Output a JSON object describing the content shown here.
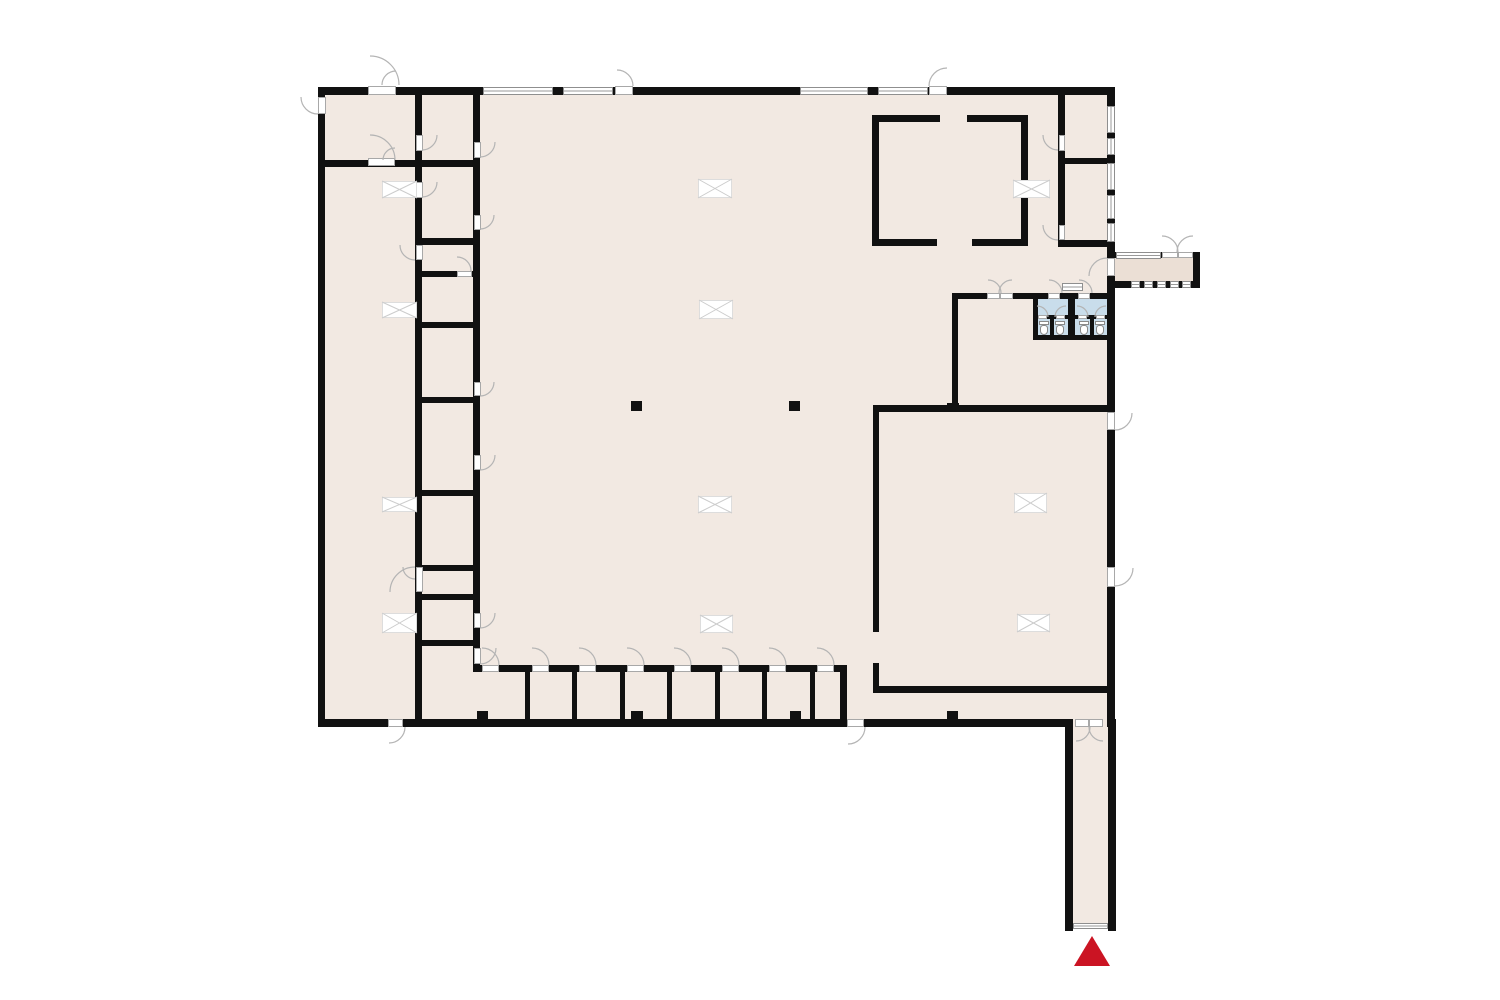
{
  "plan": {
    "canvas": {
      "width": 1500,
      "height": 1000,
      "background": "#ffffff"
    },
    "colors": {
      "floor": "#f2e9e2",
      "porch_floor": "#ebdfd5",
      "bathroom_floor": "#c9ddeb",
      "wall": "#111111",
      "door_line": "#b4b4b4",
      "window_line": "#8f8f8f",
      "hatch_line": "#cccccc",
      "marker_red": "#cb1423"
    },
    "floors": [
      {
        "rect": [
          318,
          87,
          797,
          640
        ],
        "kind": "floor"
      },
      {
        "rect": [
          1107,
          252,
          93,
          36
        ],
        "kind": "porch"
      },
      {
        "rect": [
          1065,
          719,
          51,
          206
        ],
        "kind": "floor"
      },
      {
        "rect": [
          1035,
          298,
          33,
          38
        ],
        "kind": "bath"
      },
      {
        "rect": [
          1075,
          298,
          33,
          38
        ],
        "kind": "bath"
      }
    ],
    "walls": [
      [
        318,
        87,
        797,
        8
      ],
      [
        318,
        87,
        7,
        640
      ],
      [
        318,
        719,
        754,
        8
      ],
      [
        1107,
        87,
        8,
        640
      ],
      [
        1065,
        719,
        8,
        212
      ],
      [
        1108,
        719,
        8,
        212
      ],
      [
        318,
        160,
        104,
        7
      ],
      [
        415,
        87,
        7,
        640
      ],
      [
        473,
        87,
        7,
        585
      ],
      [
        422,
        160,
        51,
        7
      ],
      [
        422,
        238,
        51,
        7
      ],
      [
        422,
        271,
        51,
        6
      ],
      [
        422,
        322,
        51,
        6
      ],
      [
        422,
        397,
        51,
        6
      ],
      [
        422,
        490,
        51,
        6
      ],
      [
        422,
        565,
        51,
        6
      ],
      [
        422,
        594,
        51,
        6
      ],
      [
        422,
        640,
        51,
        6
      ],
      [
        478,
        665,
        367,
        7
      ],
      [
        840,
        665,
        7,
        57
      ],
      [
        525,
        672,
        5,
        47
      ],
      [
        572,
        672,
        5,
        47
      ],
      [
        620,
        672,
        5,
        47
      ],
      [
        667,
        672,
        5,
        47
      ],
      [
        715,
        672,
        5,
        47
      ],
      [
        762,
        672,
        5,
        47
      ],
      [
        810,
        672,
        5,
        47
      ],
      [
        872,
        115,
        68,
        7
      ],
      [
        967,
        115,
        61,
        7
      ],
      [
        872,
        239,
        65,
        7
      ],
      [
        972,
        239,
        56,
        7
      ],
      [
        872,
        115,
        7,
        131
      ],
      [
        1021,
        115,
        7,
        131
      ],
      [
        1058,
        95,
        7,
        151
      ],
      [
        1058,
        158,
        57,
        6
      ],
      [
        1058,
        240,
        57,
        7
      ],
      [
        1107,
        252,
        93,
        6
      ],
      [
        1193,
        252,
        7,
        36
      ],
      [
        1113,
        281,
        87,
        7
      ],
      [
        953,
        293,
        160,
        6
      ],
      [
        952,
        293,
        6,
        118
      ],
      [
        873,
        405,
        242,
        7
      ],
      [
        873,
        405,
        6,
        227
      ],
      [
        873,
        663,
        6,
        30
      ],
      [
        873,
        686,
        242,
        7
      ],
      [
        1033,
        293,
        5,
        47
      ],
      [
        1068,
        293,
        7,
        47
      ],
      [
        1033,
        335,
        79,
        5
      ],
      [
        1035,
        315,
        33,
        4
      ],
      [
        1075,
        315,
        33,
        4
      ],
      [
        1050,
        317,
        4,
        18
      ],
      [
        1090,
        317,
        4,
        18
      ],
      [
        631,
        401,
        11,
        10
      ],
      [
        789,
        401,
        11,
        10
      ],
      [
        477,
        711,
        11,
        9
      ],
      [
        631,
        711,
        12,
        9
      ],
      [
        790,
        711,
        11,
        9
      ],
      [
        947,
        711,
        11,
        9
      ],
      [
        947,
        403,
        12,
        9
      ]
    ],
    "windows": [
      [
        483,
        87,
        70,
        8
      ],
      [
        563,
        87,
        50,
        8
      ],
      [
        800,
        87,
        68,
        8
      ],
      [
        878,
        87,
        50,
        8
      ],
      [
        1107,
        106,
        8,
        27
      ],
      [
        1107,
        138,
        8,
        17
      ],
      [
        1107,
        163,
        8,
        27
      ],
      [
        1107,
        195,
        8,
        24
      ],
      [
        1107,
        223,
        8,
        19
      ],
      [
        1116,
        252,
        45,
        7
      ],
      [
        1131,
        281,
        9,
        7
      ],
      [
        1144,
        281,
        9,
        7
      ],
      [
        1157,
        281,
        9,
        7
      ],
      [
        1170,
        281,
        9,
        7
      ],
      [
        1182,
        281,
        9,
        7
      ],
      [
        1062,
        283,
        21,
        8
      ],
      [
        1073,
        923,
        35,
        6
      ]
    ],
    "door_leaves": [
      [
        368,
        86,
        28,
        9
      ],
      [
        615,
        86,
        18,
        9
      ],
      [
        929,
        86,
        18,
        9
      ],
      [
        318,
        97,
        8,
        17
      ],
      [
        368,
        158,
        27,
        8
      ],
      [
        416,
        135,
        7,
        16
      ],
      [
        416,
        182,
        7,
        16
      ],
      [
        416,
        245,
        7,
        15
      ],
      [
        416,
        567,
        7,
        25
      ],
      [
        474,
        142,
        7,
        16
      ],
      [
        474,
        215,
        7,
        15
      ],
      [
        457,
        271,
        15,
        6
      ],
      [
        474,
        382,
        7,
        14
      ],
      [
        474,
        455,
        7,
        15
      ],
      [
        474,
        613,
        7,
        15
      ],
      [
        474,
        648,
        7,
        16
      ],
      [
        388,
        719,
        15,
        8
      ],
      [
        847,
        719,
        17,
        8
      ],
      [
        482,
        665,
        17,
        7
      ],
      [
        532,
        665,
        17,
        7
      ],
      [
        579,
        665,
        17,
        7
      ],
      [
        627,
        665,
        17,
        7
      ],
      [
        674,
        665,
        17,
        7
      ],
      [
        722,
        665,
        17,
        7
      ],
      [
        769,
        665,
        17,
        7
      ],
      [
        817,
        665,
        17,
        7
      ],
      [
        1075,
        719,
        14,
        8
      ],
      [
        1089,
        719,
        14,
        8
      ],
      [
        1059,
        135,
        6,
        16
      ],
      [
        1059,
        225,
        6,
        15
      ],
      [
        1107,
        258,
        8,
        18
      ],
      [
        1107,
        412,
        8,
        18
      ],
      [
        1107,
        567,
        8,
        20
      ],
      [
        1162,
        252,
        16,
        6
      ],
      [
        1178,
        252,
        15,
        6
      ],
      [
        987,
        293,
        13,
        6
      ],
      [
        1000,
        293,
        13,
        6
      ],
      [
        1048,
        293,
        12,
        6
      ],
      [
        1078,
        293,
        12,
        6
      ],
      [
        1038,
        315,
        9,
        4
      ],
      [
        1056,
        315,
        9,
        4
      ],
      [
        1078,
        315,
        9,
        4
      ],
      [
        1096,
        315,
        9,
        4
      ]
    ],
    "door_arcs": [
      [
        370,
        85,
        29,
        -90,
        0
      ],
      [
        396,
        85,
        14,
        -90,
        -180
      ],
      [
        617,
        86,
        16,
        -90,
        0
      ],
      [
        947,
        86,
        18,
        -90,
        -180
      ],
      [
        318,
        97,
        17,
        180,
        90
      ],
      [
        370,
        160,
        25,
        -90,
        0
      ],
      [
        395,
        160,
        12,
        -90,
        -180
      ],
      [
        422,
        135,
        15,
        0,
        90
      ],
      [
        422,
        182,
        15,
        0,
        90
      ],
      [
        415,
        245,
        15,
        180,
        90
      ],
      [
        480,
        142,
        15,
        0,
        90
      ],
      [
        480,
        215,
        14,
        0,
        90
      ],
      [
        457,
        271,
        14,
        -90,
        0
      ],
      [
        480,
        382,
        14,
        0,
        90
      ],
      [
        480,
        455,
        15,
        0,
        90
      ],
      [
        415,
        592,
        25,
        -90,
        -180
      ],
      [
        415,
        567,
        12,
        90,
        180
      ],
      [
        480,
        613,
        15,
        0,
        90
      ],
      [
        480,
        648,
        16,
        0,
        90
      ],
      [
        389,
        727,
        16,
        90,
        0
      ],
      [
        848,
        727,
        17,
        90,
        0
      ],
      [
        482,
        665,
        17,
        -90,
        0
      ],
      [
        532,
        665,
        17,
        -90,
        0
      ],
      [
        579,
        665,
        17,
        -90,
        0
      ],
      [
        627,
        665,
        17,
        -90,
        0
      ],
      [
        674,
        665,
        17,
        -90,
        0
      ],
      [
        722,
        665,
        17,
        -90,
        0
      ],
      [
        769,
        665,
        17,
        -90,
        0
      ],
      [
        817,
        665,
        17,
        -90,
        0
      ],
      [
        1076,
        727,
        14,
        90,
        0
      ],
      [
        1103,
        727,
        14,
        90,
        180
      ],
      [
        1058,
        135,
        15,
        90,
        180
      ],
      [
        1058,
        225,
        15,
        90,
        180
      ],
      [
        1107,
        276,
        18,
        -90,
        -180
      ],
      [
        1115,
        413,
        17,
        0,
        90
      ],
      [
        1115,
        568,
        18,
        0,
        90
      ],
      [
        1162,
        252,
        16,
        -90,
        0
      ],
      [
        1193,
        252,
        16,
        -90,
        -180
      ],
      [
        988,
        293,
        13,
        -90,
        0
      ],
      [
        1012,
        293,
        13,
        -90,
        -180
      ],
      [
        1049,
        293,
        13,
        -90,
        0
      ],
      [
        1079,
        293,
        13,
        -90,
        0
      ],
      [
        1037,
        317,
        11,
        -90,
        0
      ],
      [
        1066,
        317,
        11,
        -90,
        -180
      ],
      [
        1077,
        317,
        11,
        -90,
        0
      ],
      [
        1106,
        317,
        11,
        -90,
        -180
      ]
    ],
    "roof_hatches": [
      [
        698,
        179,
        34,
        19
      ],
      [
        699,
        300,
        34,
        19
      ],
      [
        698,
        496,
        34,
        17
      ],
      [
        700,
        615,
        33,
        18
      ],
      [
        382,
        181,
        35,
        17
      ],
      [
        382,
        302,
        35,
        16
      ],
      [
        382,
        497,
        35,
        15
      ],
      [
        382,
        613,
        35,
        20
      ],
      [
        1013,
        180,
        37,
        18
      ],
      [
        1014,
        493,
        33,
        20
      ],
      [
        1017,
        614,
        33,
        18
      ]
    ],
    "toilets": [
      [
        1039,
        321,
        10,
        14
      ],
      [
        1055,
        321,
        10,
        14
      ],
      [
        1079,
        321,
        10,
        14
      ],
      [
        1095,
        321,
        10,
        14
      ]
    ],
    "entrance_marker": {
      "x": 1074,
      "y": 936,
      "base": 36,
      "height": 30,
      "color": "#cb1423"
    }
  }
}
